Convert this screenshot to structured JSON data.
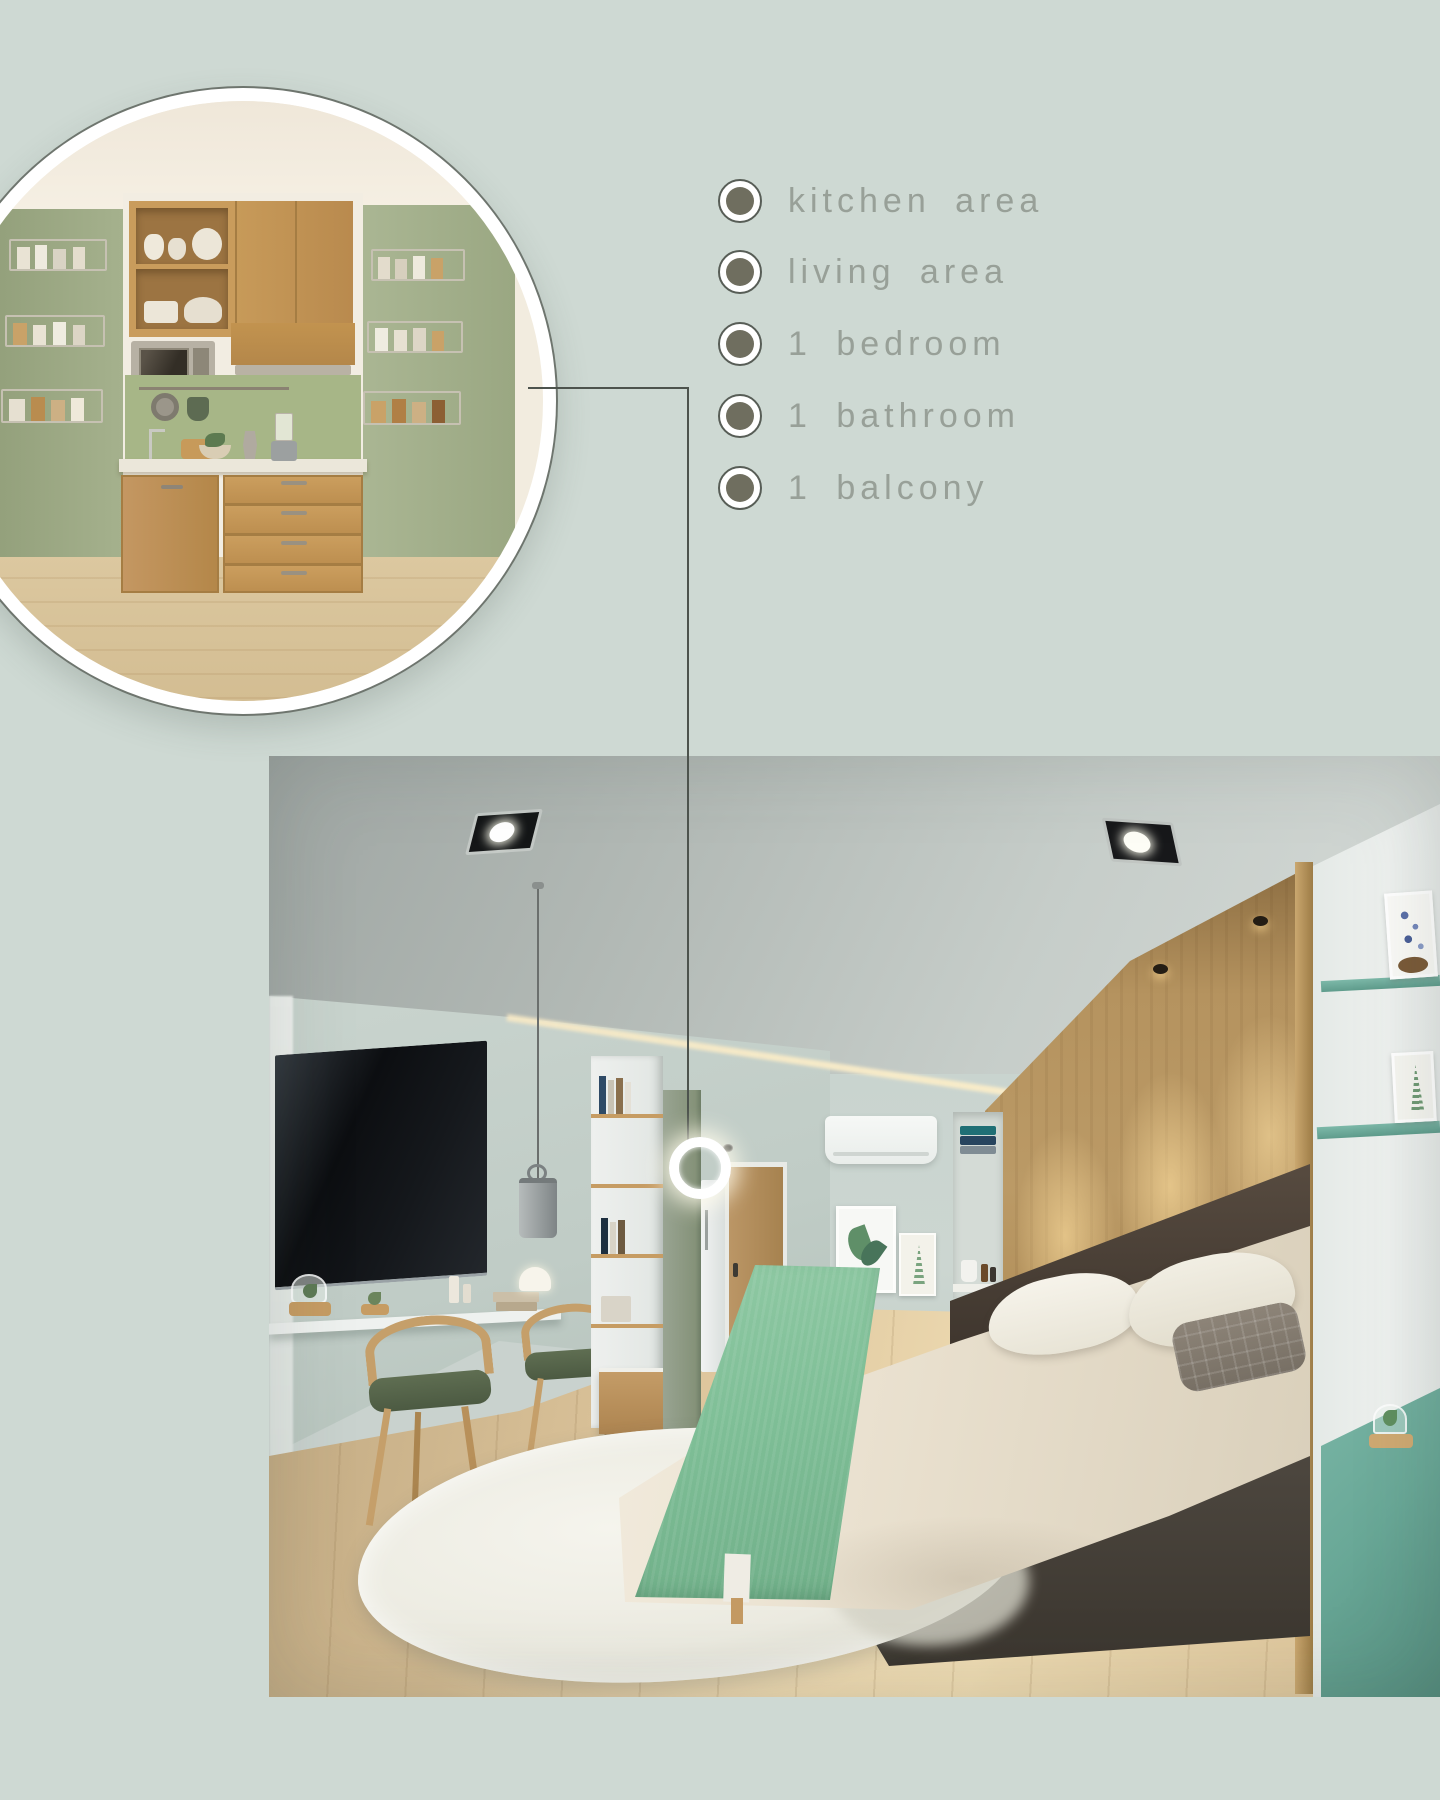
{
  "canvas": {
    "width": 1440,
    "height": 1800,
    "background": "#ced9d3"
  },
  "features": {
    "items": [
      {
        "label": "kitchen area"
      },
      {
        "label": "living area"
      },
      {
        "label": "1 bedroom"
      },
      {
        "label": "1 bathroom"
      },
      {
        "label": "1 balcony"
      }
    ],
    "text_color": "#98a098",
    "bullet_dot_color": "#6f6e5f",
    "bullet_ring_color": "#ffffff"
  },
  "callout": {
    "line_color": "#4d534d",
    "marker": "white-ring"
  },
  "palette": {
    "background_sage": "#ced9d3",
    "wall_sage": "#c6d1cb",
    "kitchen_wall_green": "#a3b08c",
    "cabinet_oak": "#c79a59",
    "bed_throw_green": "#7fbf97",
    "teal_shelf": "#6fae9c",
    "wood_headboard": "#b5935f",
    "floor_oak": "#e0c99f",
    "tv_black": "#101214"
  }
}
